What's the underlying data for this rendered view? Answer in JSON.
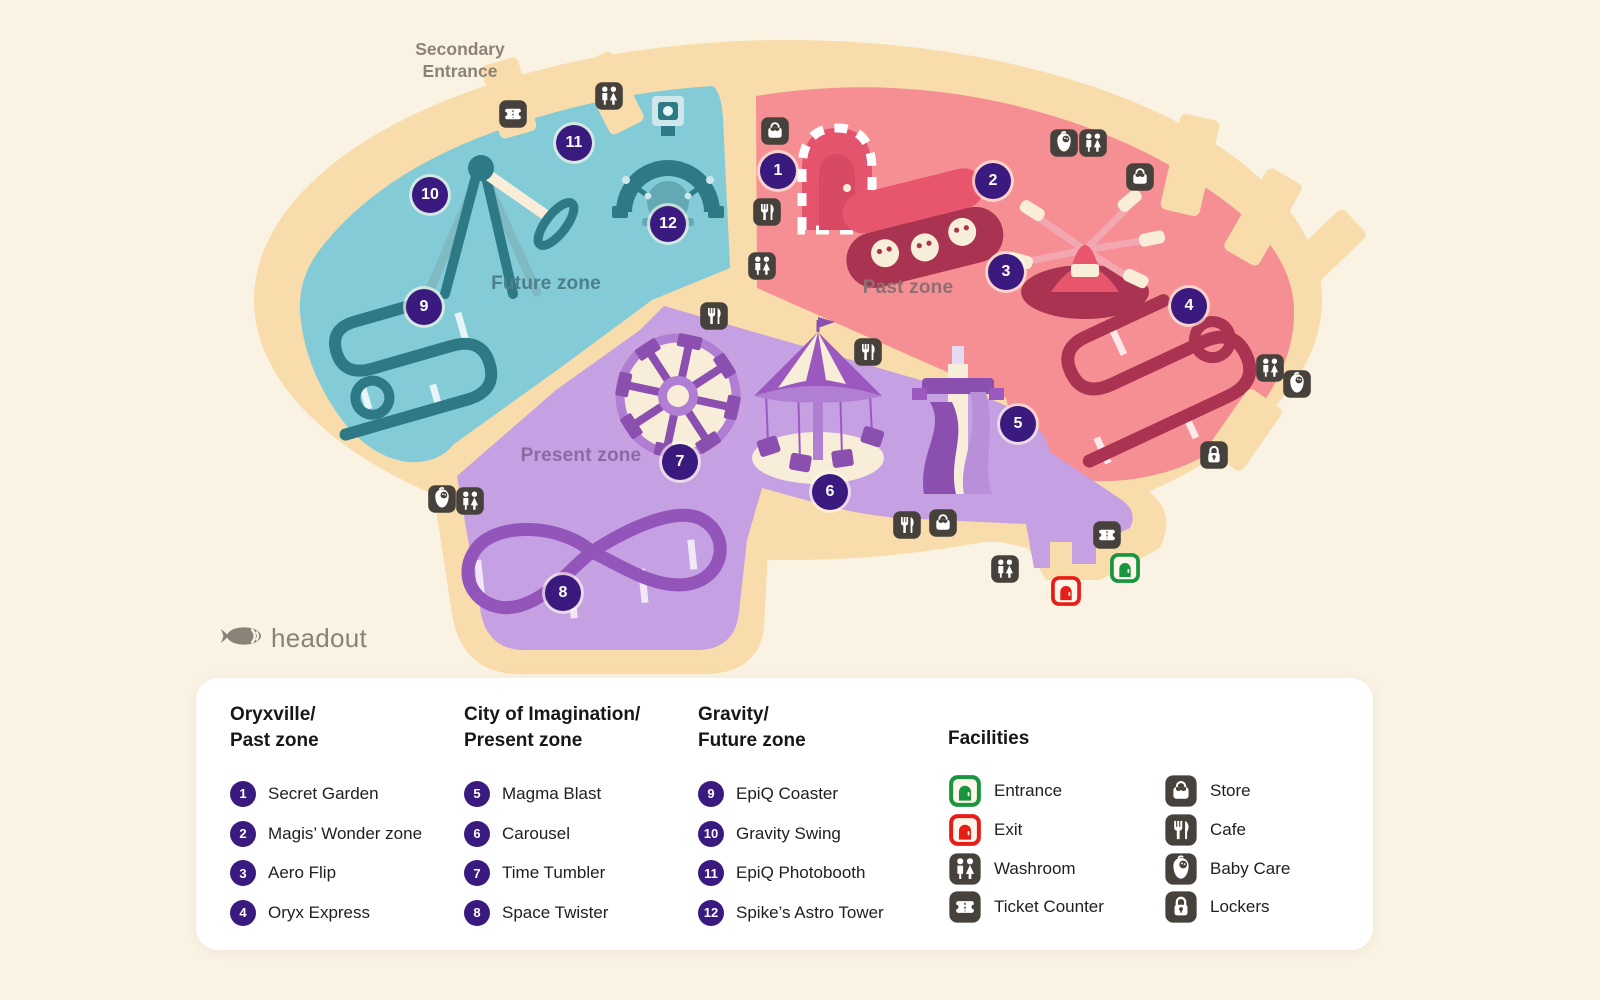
{
  "colors": {
    "background": "#faf2e3",
    "path": "#f9dcab",
    "future_zone": "#82cbd7",
    "past_zone": "#f58f94",
    "present_zone": "#c5a0e2",
    "marker": "#3a1a7e",
    "icon_bg": "#46413b",
    "entrance": "#18953e",
    "exit": "#e71d18"
  },
  "map": {
    "secondary_entrance": {
      "lines": [
        "Secondary",
        "Entrance"
      ],
      "x": 460,
      "y": 38
    },
    "zone_labels": [
      {
        "id": "future",
        "text": "Future zone",
        "x": 546,
        "y": 284,
        "color": "#4d7f8a"
      },
      {
        "id": "past",
        "text": "Past zone",
        "x": 908,
        "y": 288,
        "color": "#8f6f72"
      },
      {
        "id": "present",
        "text": "Present zone",
        "x": 581,
        "y": 456,
        "color": "#8b6ba3"
      }
    ],
    "markers": [
      {
        "n": 1,
        "x": 778,
        "y": 171
      },
      {
        "n": 2,
        "x": 993,
        "y": 181
      },
      {
        "n": 3,
        "x": 1006,
        "y": 272
      },
      {
        "n": 4,
        "x": 1189,
        "y": 306
      },
      {
        "n": 5,
        "x": 1018,
        "y": 424
      },
      {
        "n": 6,
        "x": 830,
        "y": 492
      },
      {
        "n": 7,
        "x": 680,
        "y": 462
      },
      {
        "n": 8,
        "x": 563,
        "y": 593
      },
      {
        "n": 9,
        "x": 424,
        "y": 307
      },
      {
        "n": 10,
        "x": 430,
        "y": 195
      },
      {
        "n": 11,
        "x": 574,
        "y": 143
      },
      {
        "n": 12,
        "x": 668,
        "y": 224
      }
    ],
    "facility_icons": [
      {
        "t": "ticket",
        "x": 513,
        "y": 114
      },
      {
        "t": "washroom",
        "x": 609,
        "y": 96
      },
      {
        "t": "store",
        "x": 775,
        "y": 131
      },
      {
        "t": "cafe",
        "x": 767,
        "y": 212
      },
      {
        "t": "washroom",
        "x": 762,
        "y": 266
      },
      {
        "t": "babycare",
        "x": 1064,
        "y": 143
      },
      {
        "t": "washroom",
        "x": 1093,
        "y": 143
      },
      {
        "t": "store",
        "x": 1140,
        "y": 177
      },
      {
        "t": "washroom",
        "x": 1270,
        "y": 368
      },
      {
        "t": "babycare",
        "x": 1297,
        "y": 384
      },
      {
        "t": "lockers",
        "x": 1214,
        "y": 455
      },
      {
        "t": "cafe",
        "x": 714,
        "y": 316
      },
      {
        "t": "cafe",
        "x": 868,
        "y": 352
      },
      {
        "t": "babycare",
        "x": 442,
        "y": 499
      },
      {
        "t": "washroom",
        "x": 470,
        "y": 501
      },
      {
        "t": "cafe",
        "x": 907,
        "y": 525
      },
      {
        "t": "store",
        "x": 943,
        "y": 523
      },
      {
        "t": "washroom",
        "x": 1005,
        "y": 569
      },
      {
        "t": "ticket",
        "x": 1107,
        "y": 535
      }
    ],
    "doors": [
      {
        "t": "entrance",
        "x": 1125,
        "y": 568
      },
      {
        "t": "exit",
        "x": 1066,
        "y": 591
      }
    ]
  },
  "logo": {
    "text": "headout"
  },
  "legend": {
    "groups": [
      {
        "title_lines": [
          "Oryxville/",
          "Past zone"
        ],
        "items": [
          {
            "n": 1,
            "label": "Secret Garden"
          },
          {
            "n": 2,
            "label": "Magis’ Wonder zone"
          },
          {
            "n": 3,
            "label": "Aero Flip"
          },
          {
            "n": 4,
            "label": "Oryx Express"
          }
        ]
      },
      {
        "title_lines": [
          "City of Imagination/",
          "Present zone"
        ],
        "items": [
          {
            "n": 5,
            "label": "Magma Blast"
          },
          {
            "n": 6,
            "label": "Carousel"
          },
          {
            "n": 7,
            "label": "Time Tumbler"
          },
          {
            "n": 8,
            "label": "Space Twister"
          }
        ]
      },
      {
        "title_lines": [
          "Gravity/",
          "Future zone"
        ],
        "items": [
          {
            "n": 9,
            "label": "EpiQ Coaster"
          },
          {
            "n": 10,
            "label": "Gravity Swing"
          },
          {
            "n": 11,
            "label": "EpiQ Photobooth"
          },
          {
            "n": 12,
            "label": "Spike’s Astro Tower"
          }
        ]
      }
    ],
    "facilities": {
      "title": "Facilities",
      "columns": [
        [
          {
            "icon": "entrance",
            "label": "Entrance"
          },
          {
            "icon": "exit",
            "label": "Exit"
          },
          {
            "icon": "washroom",
            "label": "Washroom"
          },
          {
            "icon": "ticket",
            "label": "Ticket Counter"
          }
        ],
        [
          {
            "icon": "store",
            "label": "Store"
          },
          {
            "icon": "cafe",
            "label": "Cafe"
          },
          {
            "icon": "babycare",
            "label": "Baby Care"
          },
          {
            "icon": "lockers",
            "label": "Lockers"
          }
        ]
      ]
    }
  }
}
